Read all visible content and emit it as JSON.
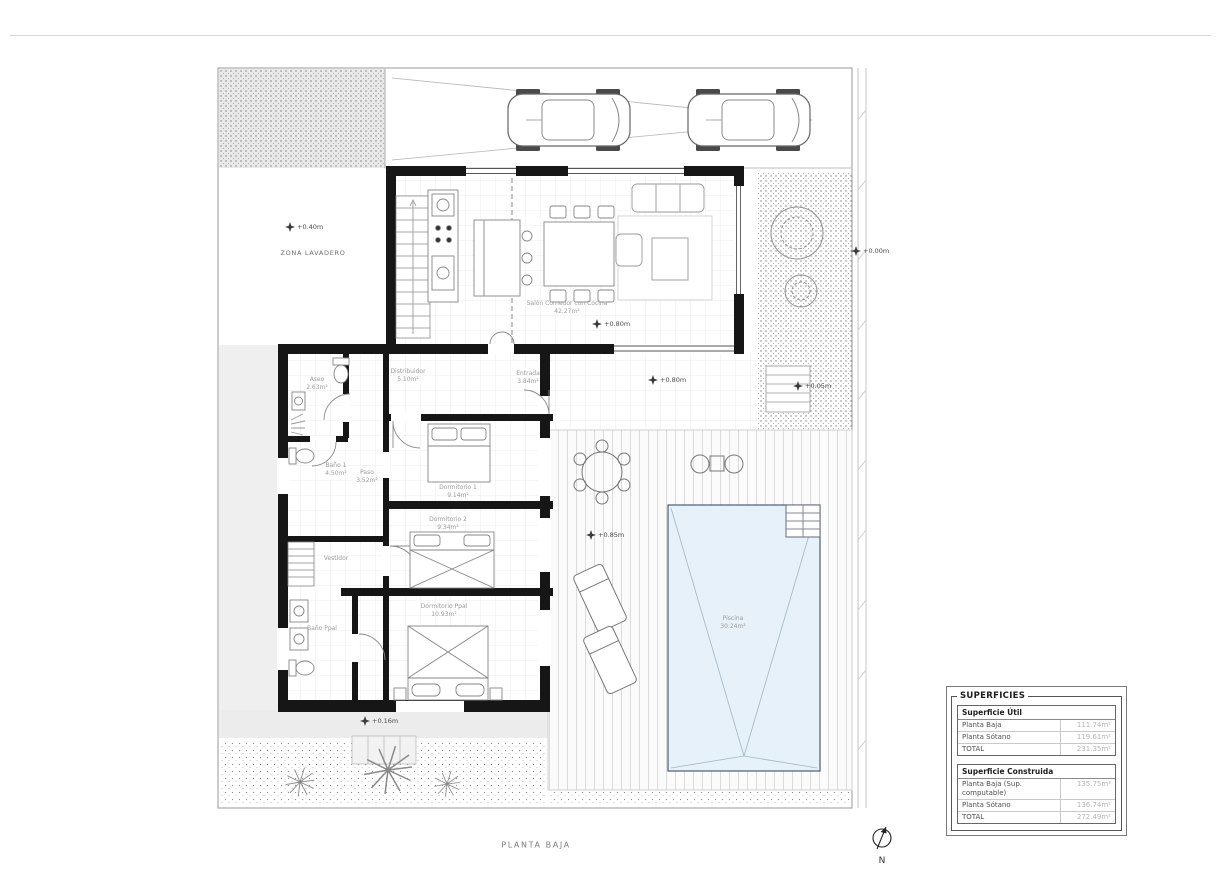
{
  "title": "PLANTA BAJA",
  "north": "N",
  "zone_label": "ZONA LAVADERO",
  "rooms": {
    "salon": {
      "name": "Salón Comedor con Cocina",
      "area": "42.27m²"
    },
    "distribuidor": {
      "name": "Distribuidor",
      "area": "5.10m²"
    },
    "entrada": {
      "name": "Entrada",
      "area": "3.84m²"
    },
    "aseo": {
      "name": "Aseo",
      "area": "2.63m²"
    },
    "bano1": {
      "name": "Baño 1",
      "area": "4.50m²"
    },
    "paso": {
      "name": "Paso",
      "area": "3.52m²"
    },
    "dormitorio1": {
      "name": "Dormitorio 1",
      "area": "9.14m²"
    },
    "dormitorio2": {
      "name": "Dormitorio 2",
      "area": "9.34m²"
    },
    "vestidor": {
      "name": "Vestidor"
    },
    "bano_ppal": {
      "name": "Baño Ppal"
    },
    "dormitorio_ppal": {
      "name": "Dormitorio Ppal",
      "area": "10.93m²"
    },
    "piscina": {
      "name": "Piscina",
      "area": "30.24m²"
    }
  },
  "levels": {
    "lavadero": "+0.40m",
    "salon": "+0.80m",
    "terraza": "+0.80m",
    "calle": "+0.00m",
    "escalera": "+0.05m",
    "deck": "+0.85m",
    "jardin": "+0.16m"
  },
  "superficies": {
    "title": "SUPERFICIES",
    "util": {
      "title": "Superficie Útil",
      "rows": [
        {
          "label": "Planta Baja",
          "value": "111.74m²"
        },
        {
          "label": "Planta Sótano",
          "value": "119.61m²"
        },
        {
          "label": "TOTAL",
          "value": "231.35m²"
        }
      ]
    },
    "construida": {
      "title": "Superficie Construida",
      "rows": [
        {
          "label": "Planta Baja (Sup. computable)",
          "value": "135.75m²"
        },
        {
          "label": "Planta Sótano",
          "value": "136.74m²"
        },
        {
          "label": "TOTAL",
          "value": "272.49m²"
        }
      ]
    }
  }
}
